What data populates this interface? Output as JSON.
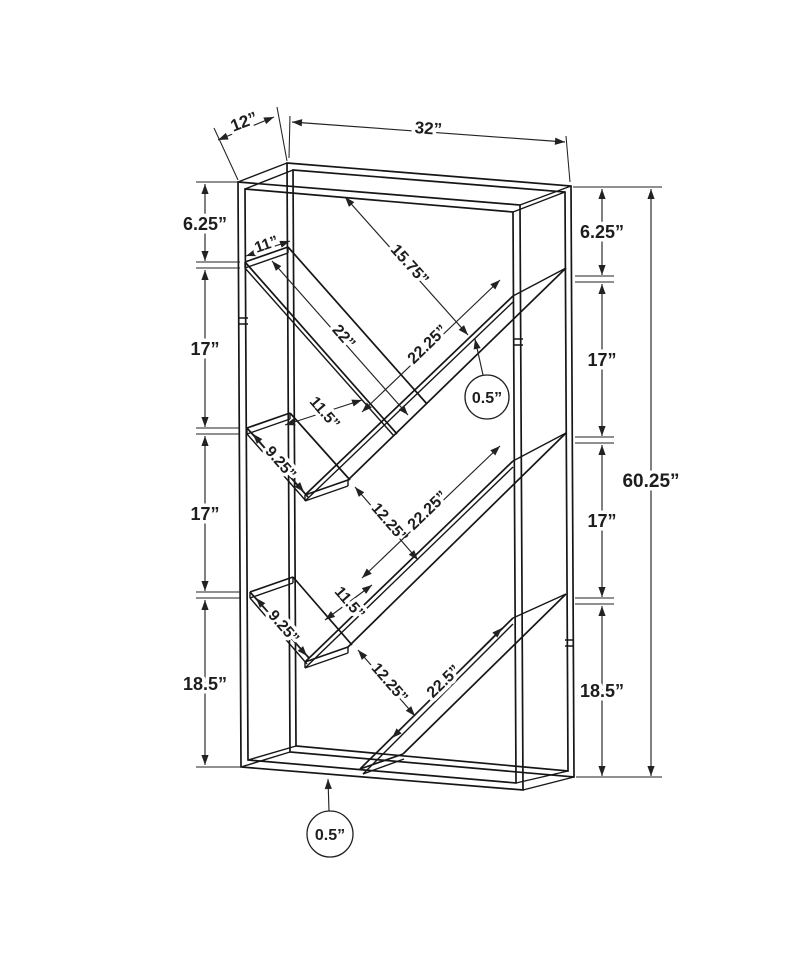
{
  "labels": {
    "depth": "12”",
    "width": "32”",
    "height": "60.25”",
    "left": [
      "6.25”",
      "17”",
      "17”",
      "18.5”"
    ],
    "right": [
      "6.25”",
      "17”",
      "17”",
      "18.5”"
    ],
    "shelf_end_width": "11”",
    "top_shelf_length": "22”",
    "top_opening": "15.75”",
    "stringers": [
      "22.25”",
      "22.25”",
      "22.5”"
    ],
    "left_gaps": [
      "11.5”",
      "11.5”"
    ],
    "right_gaps": [
      "12.25”",
      "12.25”"
    ],
    "short_shelves": [
      "9.25”",
      "9.25”"
    ],
    "thickness_callouts": [
      "0.5”",
      "0.5”"
    ]
  }
}
